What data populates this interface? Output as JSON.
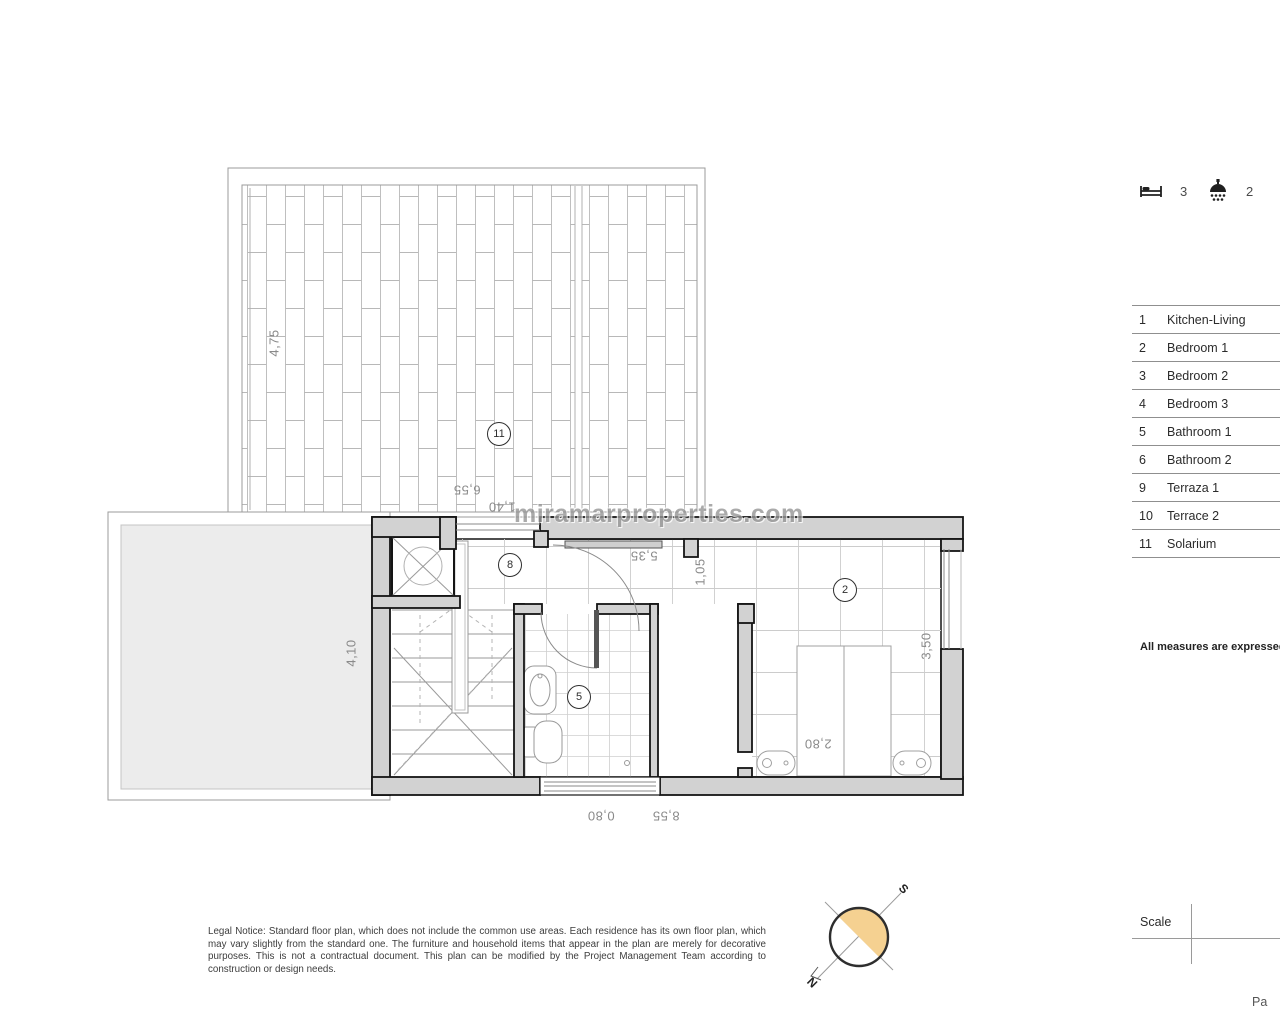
{
  "watermark": "miramarproperties.com",
  "header_icons": {
    "bed_count": "3",
    "shower_count": "2"
  },
  "legend_table": {
    "rows": [
      {
        "num": "1",
        "name": "Kitchen-Living",
        "value": "3"
      },
      {
        "num": "2",
        "name": "Bedroom 1",
        "value": "1"
      },
      {
        "num": "3",
        "name": "Bedroom 2",
        "value": "1"
      },
      {
        "num": "4",
        "name": "Bedroom 3",
        "value": "1"
      },
      {
        "num": "5",
        "name": "Bathroom 1",
        "value": ""
      },
      {
        "num": "6",
        "name": "Bathroom 2",
        "value": ""
      },
      {
        "num": "9",
        "name": "Terraza 1",
        "value": ""
      },
      {
        "num": "10",
        "name": "Terrace 2",
        "value": "1"
      },
      {
        "num": "11",
        "name": "Solarium",
        "value": "3"
      }
    ]
  },
  "plan": {
    "rooms": {
      "solarium": "11",
      "hall": "8",
      "bathroom": "5",
      "bedroom": "2"
    },
    "dims": {
      "solarium_h": "4,75",
      "solarium_w": "6,55",
      "solarium_s": "1,40",
      "terrace_h": "4,10",
      "hall_w": "5,35",
      "closet_w": "1,05",
      "bedroom_h": "3,50",
      "bed_w": "2,80",
      "bottom_s": "0,80",
      "bottom_w": "8,55"
    }
  },
  "compass": {
    "north_label": "N",
    "south_label": "S"
  },
  "footer": {
    "legal_notice": "Legal Notice: Standard floor plan, which does not include the common use areas. Each residence has its own floor plan, which may vary slightly from the standard one. The furniture and household items that appear in the plan are merely for decorative purposes. This is not a contractual document. This plan can be modified by the Project Management Team according to construction or design needs.",
    "measures_note": "All measures are expressed in M",
    "scale_label": "Scale",
    "page_label": "Pa"
  },
  "colors": {
    "wall_fill": "#d2d2d2",
    "wall_stroke": "#141414",
    "compass_fill": "#f5d191",
    "grid_line": "#cccccc",
    "dim_text": "#8a8a8a"
  }
}
